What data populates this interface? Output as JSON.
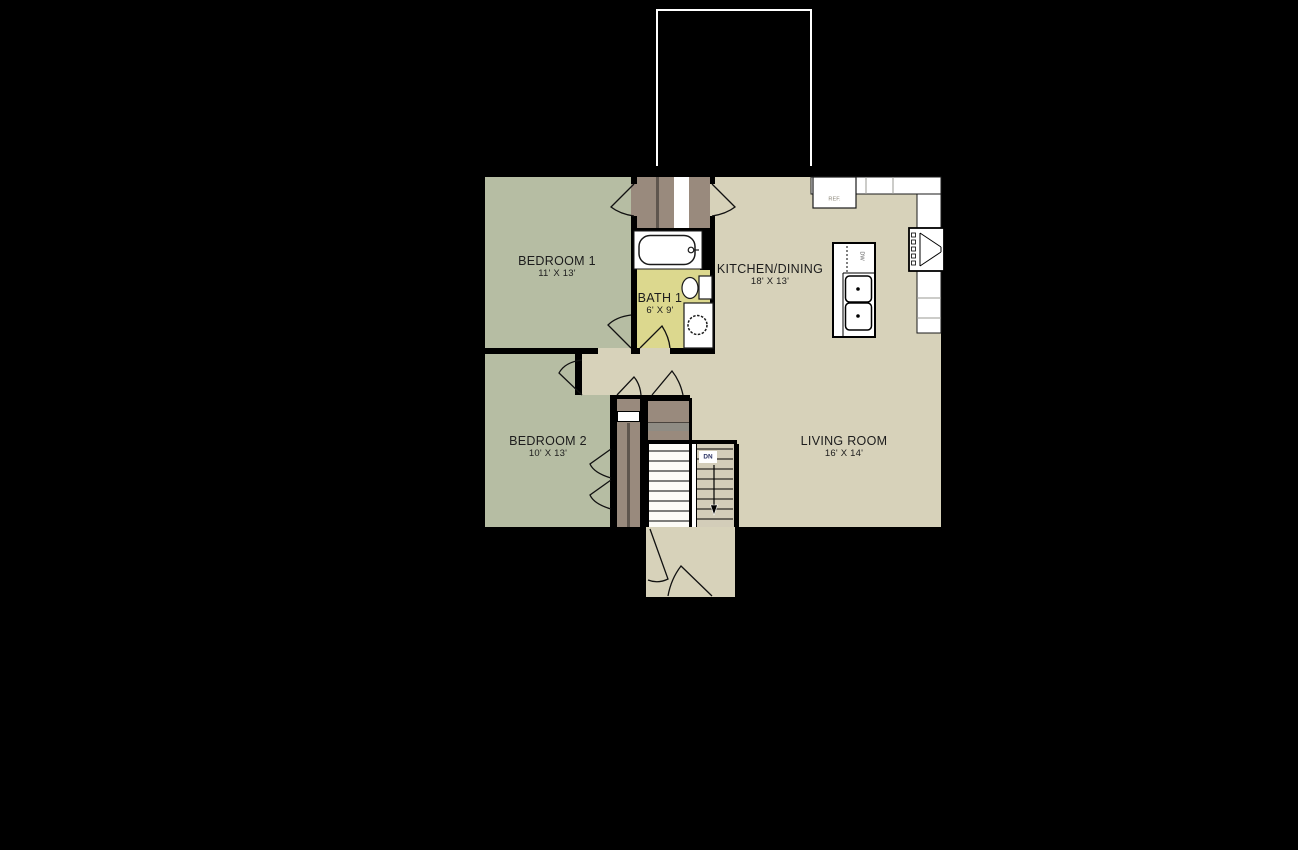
{
  "title": "Main level floor plan",
  "rooms": [
    {
      "id": "bedroom-1",
      "name": "BEDROOM 1",
      "dims": "11' X 13'"
    },
    {
      "id": "bath-1",
      "name": "BATH 1",
      "dims": "6' X 9'"
    },
    {
      "id": "kitchen-dining",
      "name": "KITCHEN/DINING",
      "dims": "18' X 13'"
    },
    {
      "id": "bedroom-2",
      "name": "BEDROOM 2",
      "dims": "10' X 13'"
    },
    {
      "id": "living-room",
      "name": "LIVING ROOM",
      "dims": "16' X 14'"
    }
  ],
  "labels": {
    "refrigerator": "REF.",
    "dishwasher": "DW",
    "stairs_down": "DN"
  },
  "colors": {
    "background": "#000000",
    "floor_green": "#b6bda3",
    "floor_tan": "#d7d2ba",
    "bath_yellow": "#dcd88e",
    "closet_brown": "#998a7d",
    "closet_brown_dark": "#5f564e",
    "shelf_gray": "#8f8c84",
    "stairs_tan": "#d3cdb9",
    "wall_black": "#000000",
    "fixture_white": "#ffffff",
    "deck_outline": "#ffffff",
    "dn_navy": "#2b3263",
    "label_ink": "#1c1c1c"
  }
}
